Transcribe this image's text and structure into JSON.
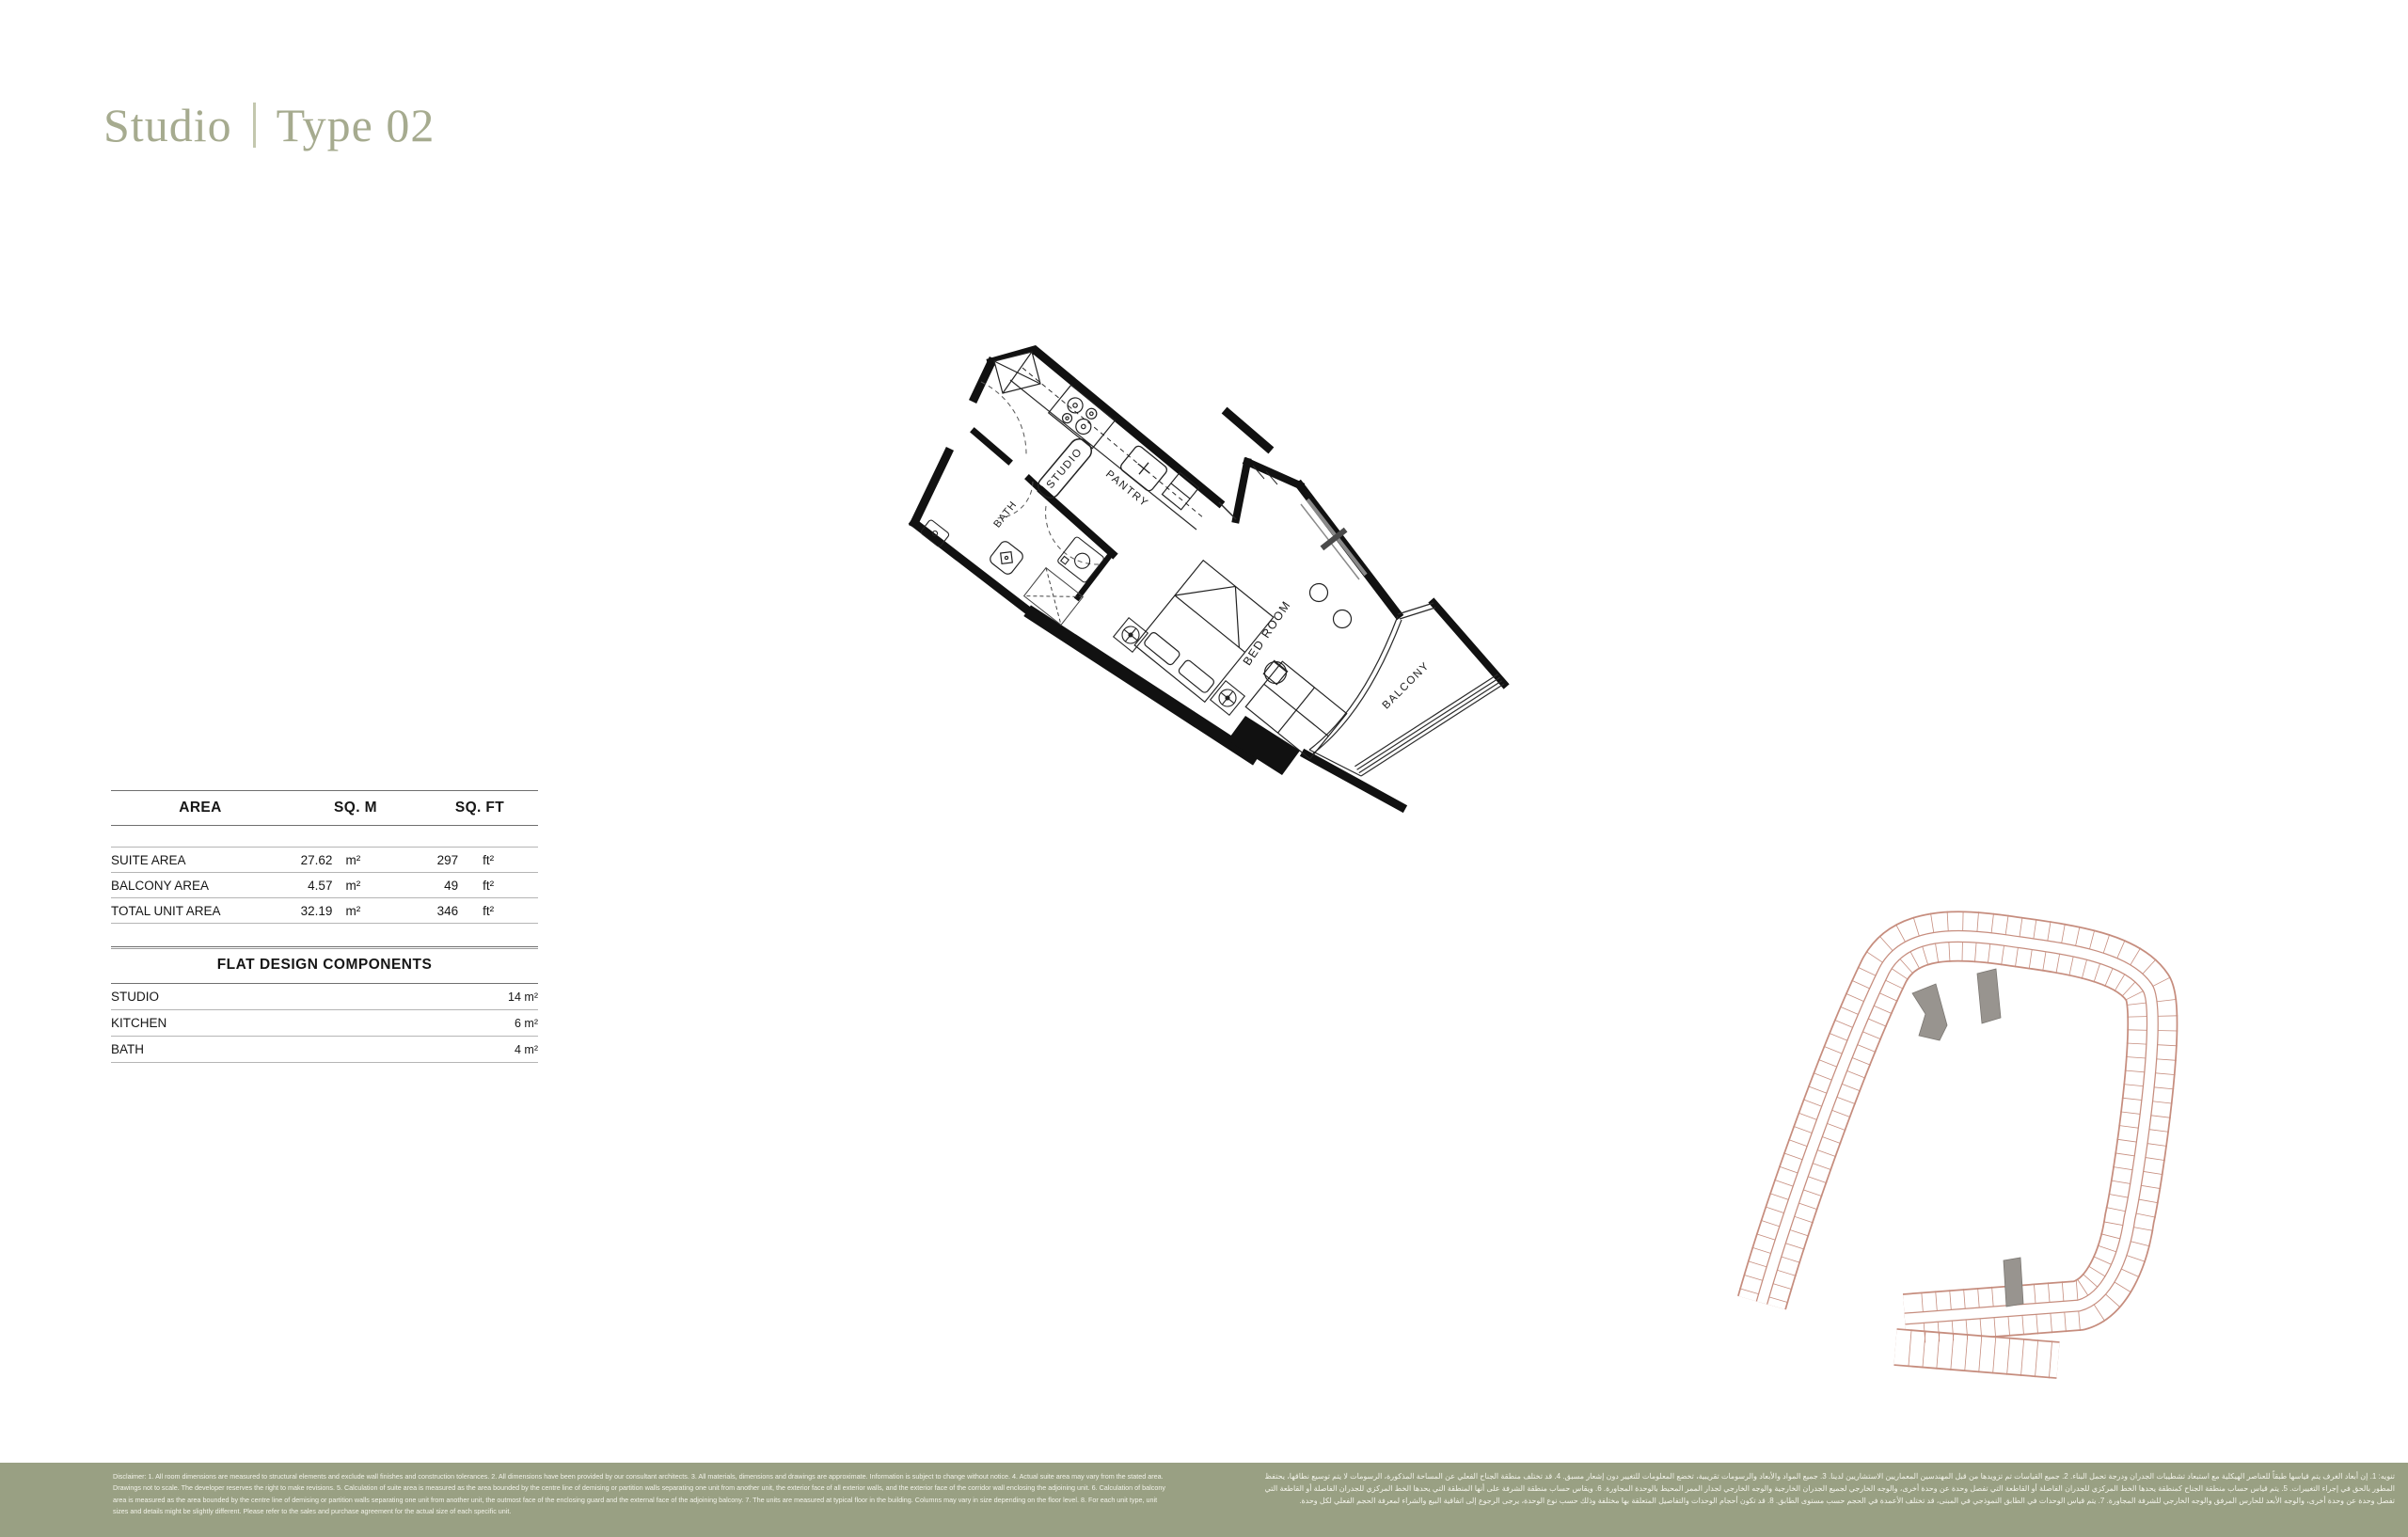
{
  "title": {
    "primary": "Studio",
    "secondary": "Type 02"
  },
  "area_table": {
    "col_area": "AREA",
    "col_sqm": "SQ. M",
    "col_sqft": "SQ. FT",
    "rows": [
      {
        "label": "SUITE AREA",
        "sqm": "27.62",
        "sqm_unit": "m²",
        "sqft": "297",
        "sqft_unit": "ft²"
      },
      {
        "label": "BALCONY AREA",
        "sqm": "4.57",
        "sqm_unit": "m²",
        "sqft": "49",
        "sqft_unit": "ft²"
      },
      {
        "label": "TOTAL UNIT AREA",
        "sqm": "32.19",
        "sqm_unit": "m²",
        "sqft": "346",
        "sqft_unit": "ft²"
      }
    ]
  },
  "components_table": {
    "title": "FLAT DESIGN COMPONENTS",
    "rows": [
      {
        "label": "STUDIO",
        "value": "14",
        "unit": "m²"
      },
      {
        "label": "KITCHEN",
        "value": "6",
        "unit": "m²"
      },
      {
        "label": "BATH",
        "value": "4",
        "unit": "m²"
      }
    ]
  },
  "floor_plan": {
    "labels": {
      "studio": "STUDIO",
      "pantry": "PANTRY",
      "bath": "BATH",
      "bedroom": "BED ROOM",
      "balcony": "BALCONY"
    }
  },
  "colors": {
    "title_green": "#a6ab8f",
    "separator": "#c3c7ae",
    "footer_bg": "#99a083",
    "plan_ink": "#111111",
    "siteplan_line": "#c68d7e",
    "siteplan_highlight": "#98948f"
  },
  "footer": {
    "disclaimer_en": "Disclaimer: 1. All room dimensions are measured to structural elements and exclude wall finishes and construction tolerances. 2. All dimensions have been provided by our consultant architects. 3. All materials, dimensions and drawings are approximate. Information is subject to change without notice. 4. Actual suite area may vary from the stated area. Drawings not to scale. The developer reserves the right to make revisions. 5. Calculation of suite area is measured as the area bounded by the centre line of demising or partition walls separating one unit from another unit, the exterior face of all exterior walls, and the exterior face of the corridor wall enclosing the adjoining unit. 6. Calculation of balcony area is measured as the area bounded by the centre line of demising or partition walls separating one unit from another unit, the outmost face of the enclosing guard and the external face of the adjoining balcony. 7. The units are measured at typical floor in the building. Columns may vary in size depending on the floor level. 8. For each unit type, unit sizes and details might be slightly different. Please refer to the sales and purchase agreement for the actual size of each specific unit.",
    "disclaimer_ar": "تنويه: 1. إن أبعاد الغرف يتم قياسها طبقاً للعناصر الهيكلية مع استبعاد تشطيبات الجدران ودرجة تحمل البناء. 2. جميع القياسات تم تزويدها من قبل المهندسين المعماريين الاستشاريين لدينا. 3. جميع المواد والأبعاد والرسومات تقريبية، تخضع المعلومات للتغيير دون إشعار مسبق. 4. قد تختلف منطقة الجناح الفعلي عن المساحة المذكورة، الرسومات لا يتم توسيع نطاقها، يحتفظ المطور بالحق في إجراء التغييرات. 5. يتم قياس حساب منطقة الجناح كمنطقة يحدها الخط المركزي للجدران الفاصلة أو القاطعة التي تفصل وحدة عن وحدة أخرى، والوجه الخارجي لجميع الجدران الخارجية والوجه الخارجي لجدار الممر المحيط بالوحدة المجاورة. 6. ويقاس حساب منطقة الشرفة على أنها المنطقة التي يحدها الخط المركزي للجدران الفاصلة أو القاطعة التي تفصل وحدة عن وحدة أخرى، والوجه الأبعد للحارس المرفق والوجه الخارجي للشرفة المجاورة. 7. يتم قياس الوحدات في الطابق النموذجي في المبنى، قد تختلف الأعمدة في الحجم حسب مستوى الطابق. 8. قد تكون أحجام الوحدات والتفاصيل المتعلقة بها مختلفة وذلك حسب نوع الوحدة، يرجى الرجوع إلى اتفاقية البيع والشراء لمعرفة الحجم الفعلي لكل وحدة."
  }
}
